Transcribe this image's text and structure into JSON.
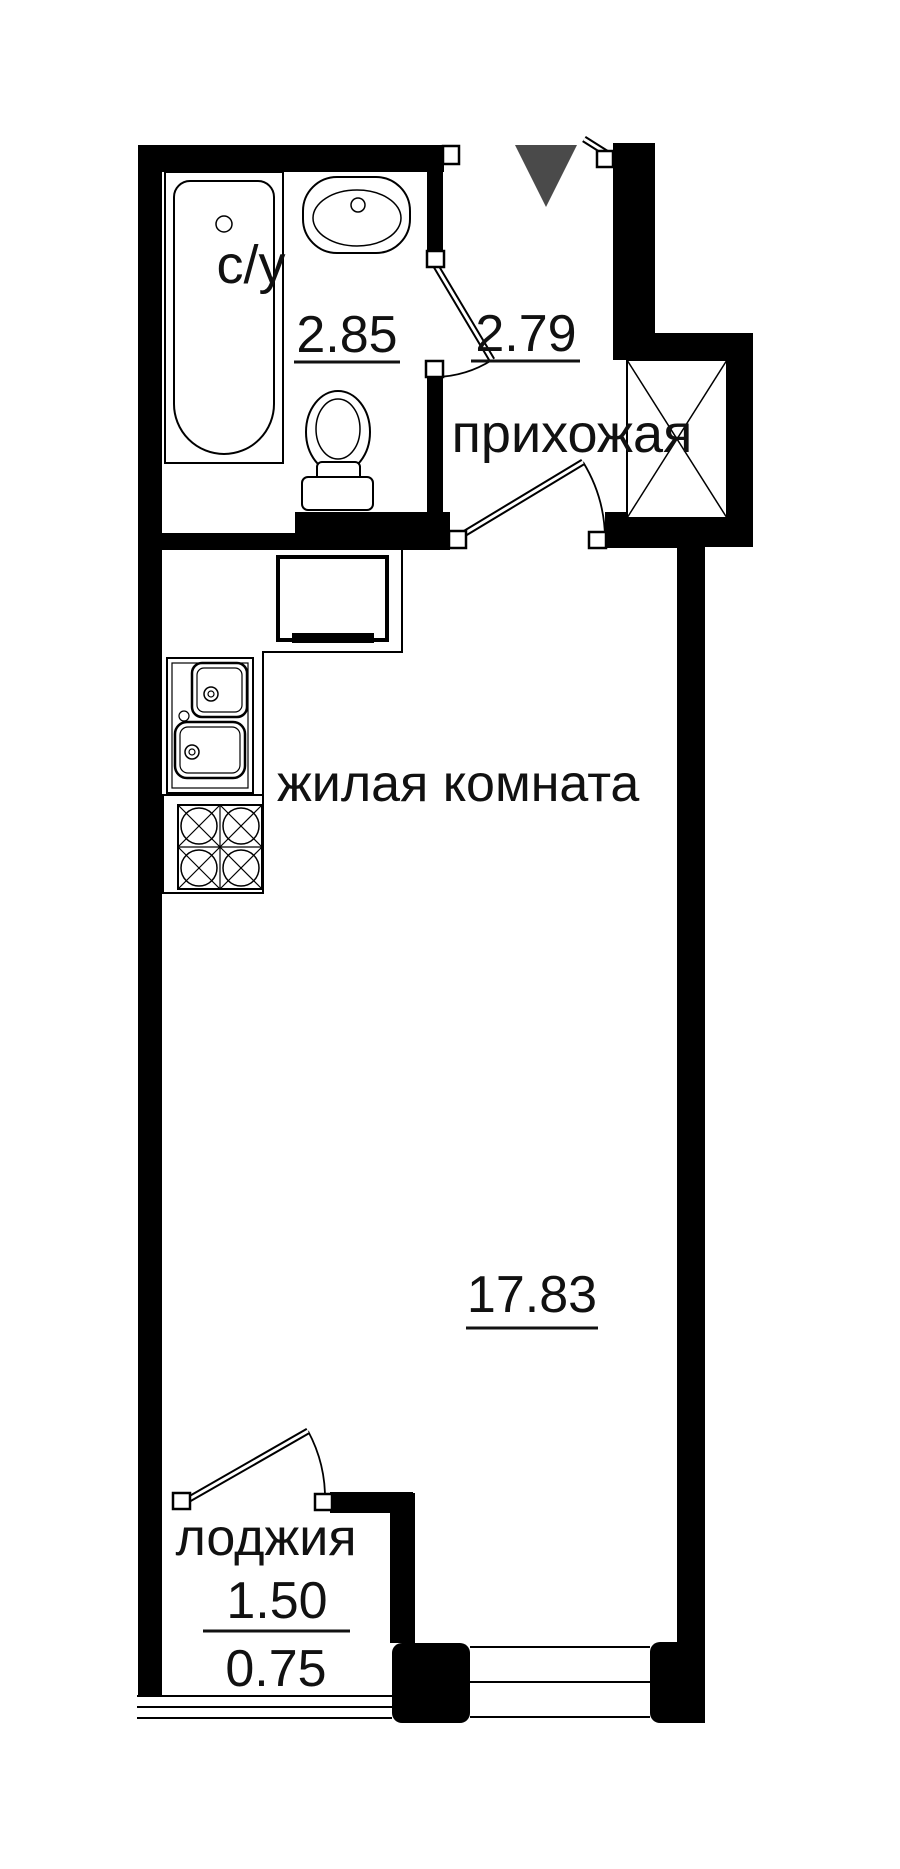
{
  "document": {
    "type": "apartment-floor-plan"
  },
  "rooms": {
    "bathroom": {
      "label": "с/у",
      "area": "2.85"
    },
    "hallway": {
      "label": "прихожая",
      "area": "2.79"
    },
    "living_room": {
      "label": "жилая комната",
      "area": "17.83"
    },
    "loggia": {
      "label": "лоджия",
      "area_total": "1.50",
      "area_counted": "0.75"
    }
  },
  "colors": {
    "wall": "#000000",
    "background": "#ffffff",
    "entrance_marker": "#4a4a4a",
    "text": "#111111"
  }
}
